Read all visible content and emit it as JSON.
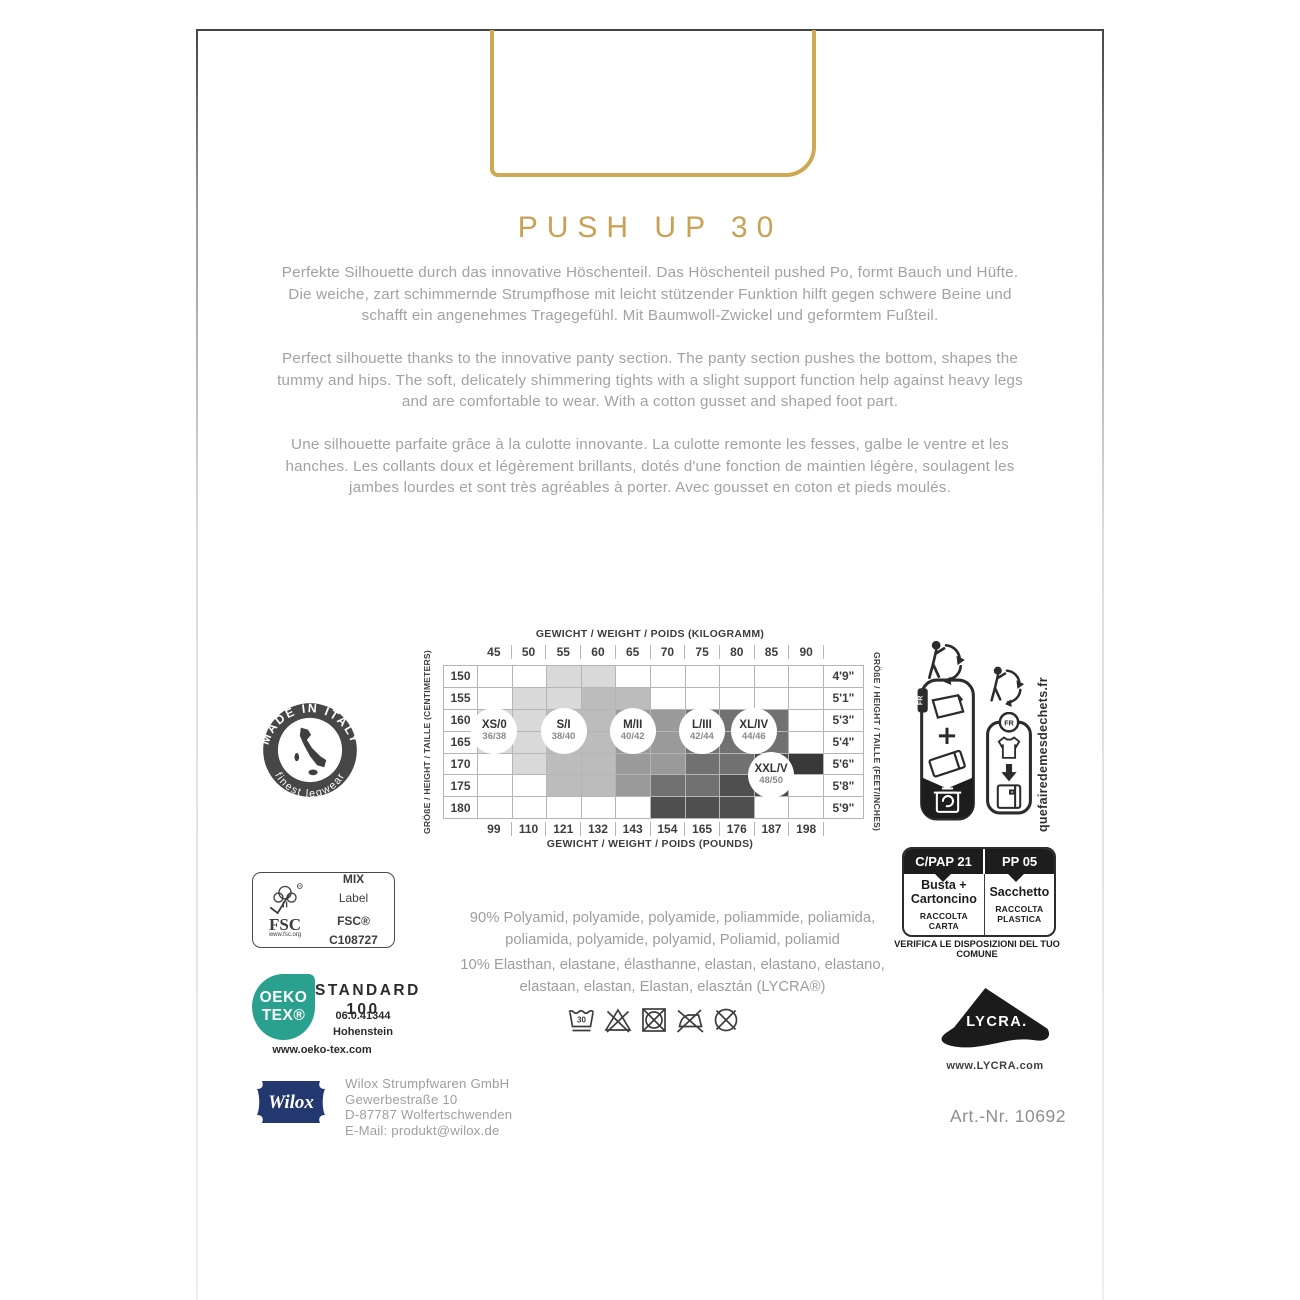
{
  "colors": {
    "gold": "#cfa852",
    "gold_text": "#c7a254",
    "body_gray": "#a2a2a2",
    "dark": "#3d3d3d",
    "teal": "#2aa18f",
    "navy": "#22386e"
  },
  "product": {
    "title": "PUSH UP 30",
    "art_nr": "Art.-Nr. 10692"
  },
  "paragraphs": {
    "de": [
      "Perfekte Silhouette durch das innovative Höschenteil. Das Höschenteil pushed Po, formt Bauch und Hüfte.",
      "Die weiche, zart schimmernde Strumpfhose mit leicht stützender Funktion hilft gegen schwere Beine und",
      "schafft ein angenehmes Tragegefühl. Mit Baumwoll-Zwickel und geformtem Fußteil."
    ],
    "en": [
      "Perfect silhouette thanks to the innovative panty section. The panty section pushes the bottom, shapes the",
      "tummy and hips. The soft, delicately shimmering tights with a slight support function help against heavy legs",
      "and are comfortable to wear. With a cotton gusset and shaped foot part."
    ],
    "fr": [
      "Une silhouette parfaite grâce à la culotte innovante. La culotte remonte les fesses, galbe le ventre et les",
      "hanches. Les collants doux et légèrement brillants, dotés d'une fonction de maintien légère, soulagent les",
      "jambes lourdes et sont très agréables à porter. Avec gousset en coton et pieds moulés."
    ]
  },
  "size_chart": {
    "type": "heatmap",
    "top_axis_label": "GEWICHT / WEIGHT / POIDS (KILOGRAMM)",
    "bottom_axis_label": "GEWICHT / WEIGHT / POIDS (POUNDS)",
    "left_axis_label": "GRÖßE / HEIGHT / TAILLE (CENTIMETERS)",
    "right_axis_label": "GRÖßE / HEIGHT / TAILLE (FEET/INCHES)",
    "weights_kg": [
      "45",
      "50",
      "55",
      "60",
      "65",
      "70",
      "75",
      "80",
      "85",
      "90"
    ],
    "weights_lbs": [
      "99",
      "110",
      "121",
      "132",
      "143",
      "154",
      "165",
      "176",
      "187",
      "198"
    ],
    "heights_cm": [
      "150",
      "155",
      "160",
      "165",
      "170",
      "175",
      "180"
    ],
    "heights_ft": [
      "4'9\"",
      "5'1\"",
      "5'3\"",
      "5'4\"",
      "5'6\"",
      "5'8\"",
      "5'9\""
    ],
    "shades": [
      "#d9d9d9",
      "#bcbcbc",
      "#9a9a9a",
      "#717171",
      "#4f4f4f",
      "#383838"
    ],
    "cells": [
      [
        0,
        0,
        1,
        1,
        0,
        0,
        0,
        0,
        0,
        0
      ],
      [
        0,
        1,
        1,
        2,
        2,
        0,
        0,
        0,
        0,
        0
      ],
      [
        1,
        1,
        2,
        2,
        3,
        3,
        4,
        4,
        4,
        0
      ],
      [
        1,
        1,
        2,
        2,
        3,
        3,
        4,
        4,
        4,
        0
      ],
      [
        0,
        1,
        2,
        2,
        3,
        3,
        4,
        4,
        5,
        6
      ],
      [
        0,
        0,
        2,
        2,
        3,
        4,
        4,
        5,
        5,
        0
      ],
      [
        0,
        0,
        0,
        0,
        0,
        5,
        5,
        5,
        0,
        0
      ]
    ],
    "sizes": [
      {
        "label": "XS/0",
        "sub": "36/38",
        "col": 0,
        "row": 2.5
      },
      {
        "label": "S/I",
        "sub": "38/40",
        "col": 2,
        "row": 2.5
      },
      {
        "label": "M/II",
        "sub": "40/42",
        "col": 4,
        "row": 2.5
      },
      {
        "label": "L/III",
        "sub": "42/44",
        "col": 6,
        "row": 2.5
      },
      {
        "label": "XL/IV",
        "sub": "44/46",
        "col": 7.5,
        "row": 2.5
      },
      {
        "label": "XXL/V",
        "sub": "48/50",
        "col": 8,
        "row": 4.5
      }
    ]
  },
  "stamps": {
    "made_in_italy": {
      "top": "MADE IN ITALY",
      "bottom": "finest legwear"
    },
    "fsc": {
      "brand": "FSC",
      "url": "www.fsc.org",
      "line1": "MIX",
      "line2": "Label",
      "code": "FSC® C108727"
    },
    "oekotex": {
      "logo_line1": "OEKO",
      "logo_line2": "TEX®",
      "title1": "STANDARD",
      "title2": "100",
      "cert": "06.0.41344",
      "institute": "Hohenstein",
      "url": "www.oeko-tex.com"
    },
    "triman": {
      "fr_tab": "FR",
      "fr_circle": "FR",
      "url": "quefairedemesdechets.fr"
    },
    "sorting_it": {
      "header_left": "C/PAP 21",
      "header_right": "PP 05",
      "left_line1": "Busta +",
      "left_line2": "Cartoncino",
      "left_sub1": "RACCOLTA",
      "left_sub2": "CARTA",
      "right_line1": "Sacchetto",
      "right_sub1": "RACCOLTA",
      "right_sub2": "PLASTICA",
      "caption": "VERIFICA LE DISPOSIZIONI DEL TUO COMUNE"
    },
    "lycra": {
      "brand": "LYCRA.",
      "url": "www.LYCRA.com"
    }
  },
  "composition": {
    "line1": "90% Polyamid, polyamide, polyamide, poliammide, poliamida,",
    "line2": "poliamida, polyamide, polyamid, Poliamid, poliamid",
    "line3": "10% Elasthan, elastane, élasthanne, elastan, elastano, elastano,",
    "line4": "elastaan, elastan, Elastan, elasztán (LYCRA®)"
  },
  "care": {
    "wash_temp": "30",
    "icons": [
      "wash-30-gentle",
      "no-bleach",
      "no-tumble-dry",
      "no-iron",
      "no-dry-clean"
    ]
  },
  "manufacturer": {
    "logo": "Wilox",
    "lines": [
      "Wilox Strumpfwaren GmbH",
      "Gewerbestraße 10",
      "D-87787 Wolfertschwenden",
      "E-Mail: produkt@wilox.de"
    ]
  }
}
